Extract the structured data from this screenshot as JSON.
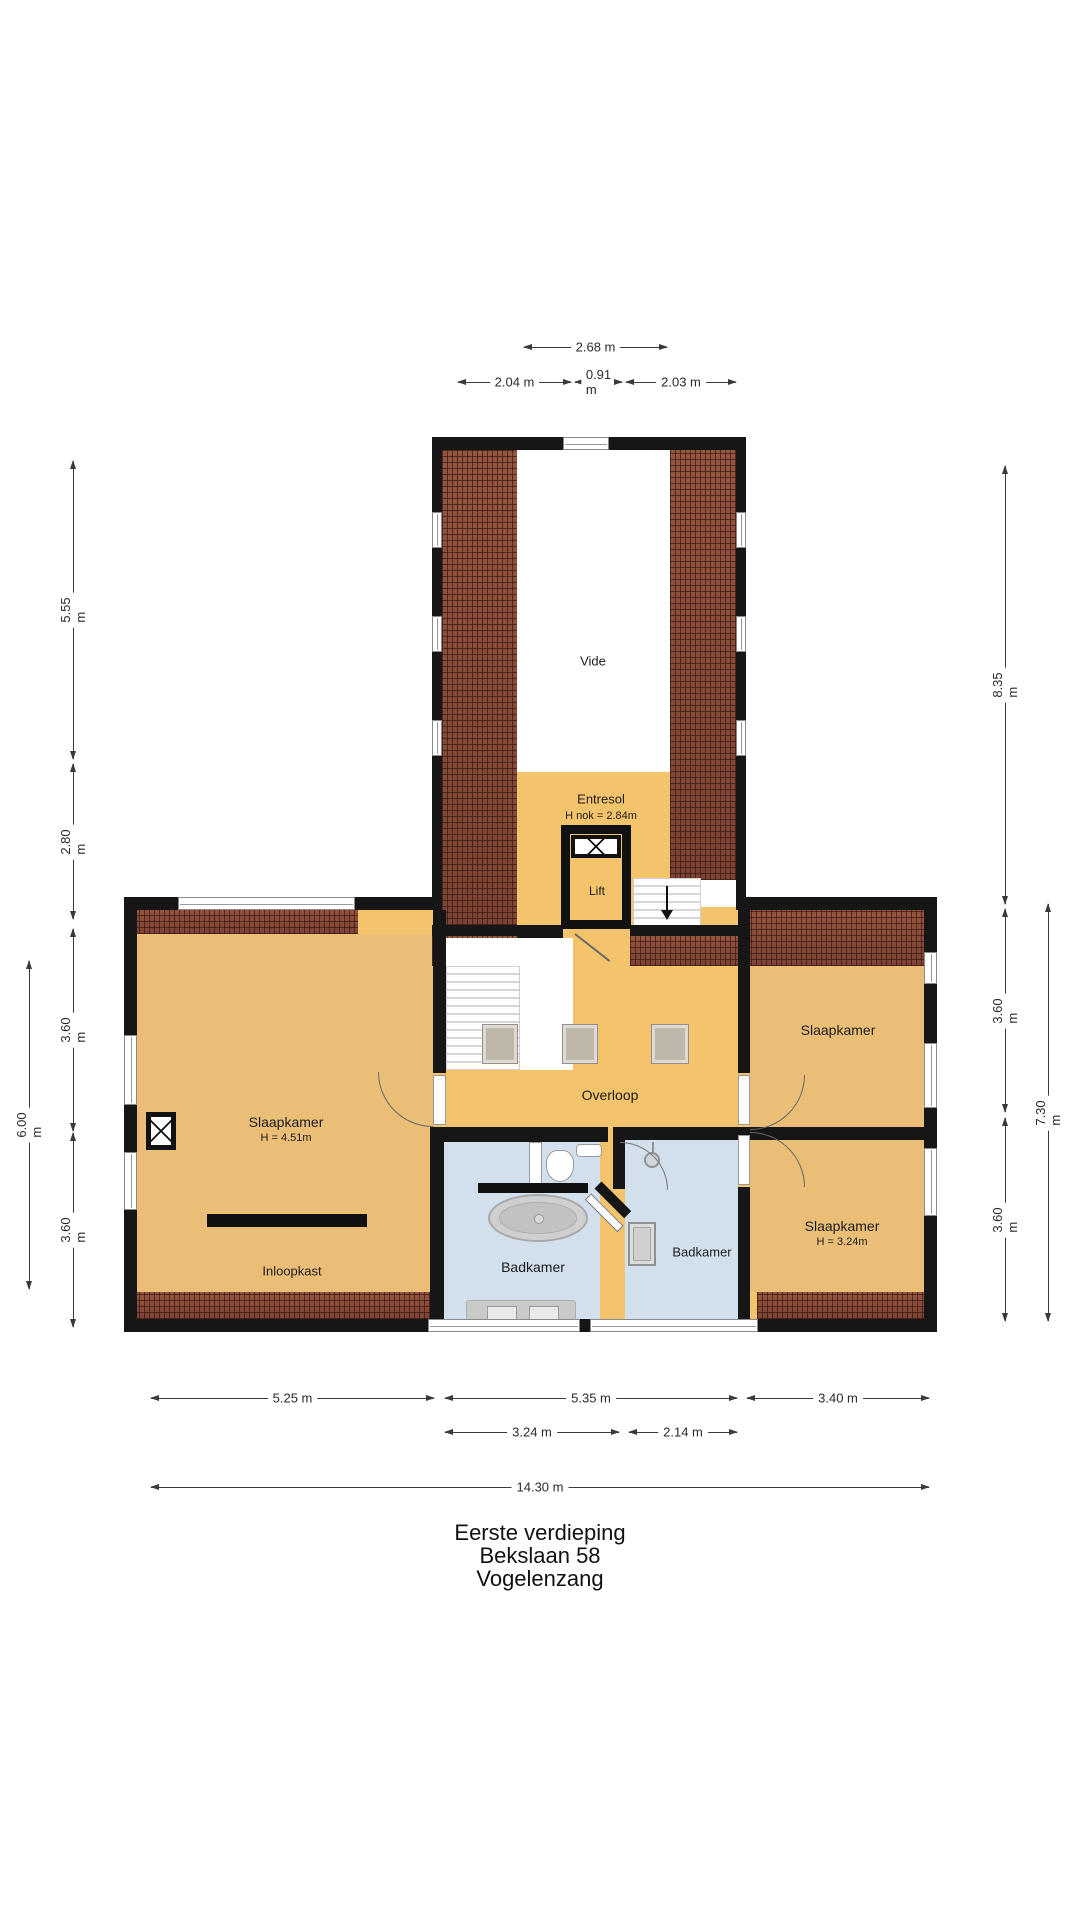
{
  "plan": {
    "type": "floorplan",
    "floor_label": "Eerste verdieping",
    "address_line1": "Bekslaan 58",
    "address_line2": "Vogelenzang"
  },
  "rooms": {
    "vide": {
      "label": "Vide"
    },
    "entresol": {
      "label": "Entresol",
      "sub": "H nok = 2.84m"
    },
    "lift": {
      "label": "Lift"
    },
    "overloop": {
      "label": "Overloop"
    },
    "slaapkamer_left": {
      "label": "Slaapkamer",
      "sub": "H = 4.51m"
    },
    "inloopkast": {
      "label": "Inloopkast"
    },
    "slaapkamer_right_top": {
      "label": "Slaapkamer"
    },
    "slaapkamer_right_bottom": {
      "label": "Slaapkamer",
      "sub": "H = 3.24m"
    },
    "badkamer_center": {
      "label": "Badkamer"
    },
    "badkamer_right": {
      "label": "Badkamer"
    }
  },
  "dims": {
    "top_total": "2.68 m",
    "top_a": "2.04 m",
    "top_b": "0.91 m",
    "top_c": "2.03 m",
    "left_tower": "5.55 m",
    "left_entresol": "2.80 m",
    "left_up": "3.60 m",
    "left_low": "3.60 m",
    "left_total": "6.00 m",
    "right_tower": "8.35 m",
    "right_up": "3.60 m",
    "right_low": "3.60 m",
    "right_total": "7.30 m",
    "bot_left": "5.25 m",
    "bot_center": "5.35 m",
    "bot_right": "3.40 m",
    "bot_center_a": "3.24 m",
    "bot_center_b": "2.14 m",
    "bot_total": "14.30 m"
  },
  "colors": {
    "floor_main": "#F4C46C",
    "floor_bedroom": "#EBBE78",
    "bathroom_floor": "#D2E0ED",
    "roof_brick": "#8A4A3A",
    "wall": "#161616",
    "dimension_text": "#2A2A2A"
  }
}
